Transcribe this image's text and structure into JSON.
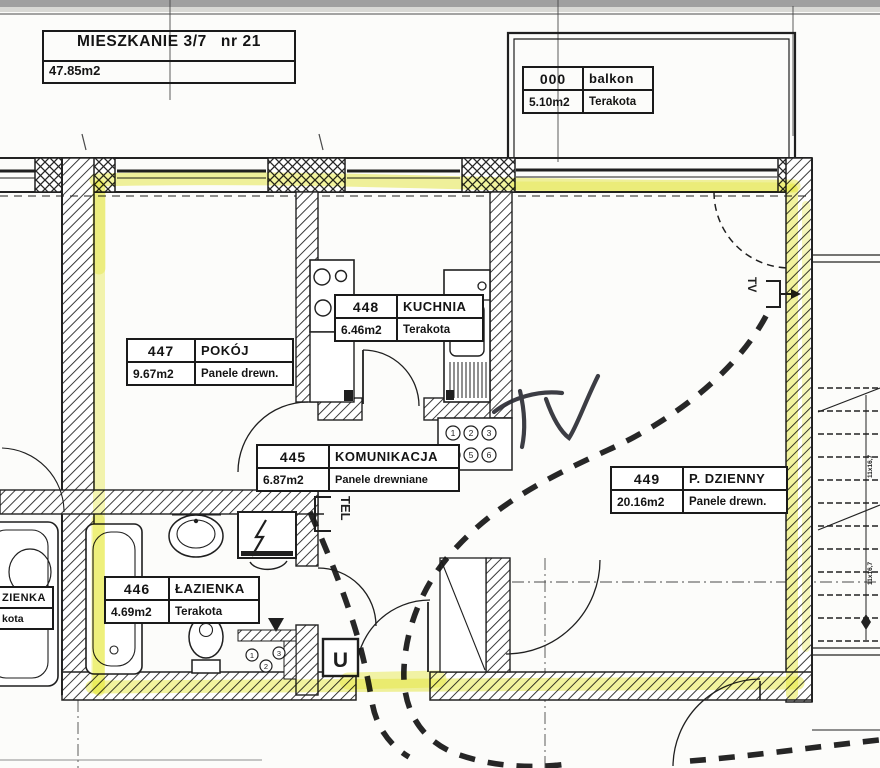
{
  "apartment": {
    "label": "MIESZKANIE 3/7",
    "unit": "nr 21",
    "total_area": "47.85m2"
  },
  "rooms": [
    {
      "id": "000",
      "name": "balkon",
      "area": "5.10m2",
      "floor": "Terakota"
    },
    {
      "id": "447",
      "name": "POKÓJ",
      "area": "9.67m2",
      "floor": "Panele drewn."
    },
    {
      "id": "448",
      "name": "KUCHNIA",
      "area": "6.46m2",
      "floor": "Terakota"
    },
    {
      "id": "445",
      "name": "KOMUNIKACJA",
      "area": "6.87m2",
      "floor": "Panele drewniane"
    },
    {
      "id": "449",
      "name": "P. DZIENNY",
      "area": "20.16m2",
      "floor": "Panele drewn."
    },
    {
      "id": "446",
      "name": "ŁAZIENKA",
      "area": "4.69m2",
      "floor": "Terakota"
    }
  ],
  "neighbor_label": {
    "name_fragment": "ZIENKA",
    "floor_fragment": "kota"
  },
  "annotations": {
    "tv_handwritten": "TV",
    "tel_socket": "TEL",
    "tv_socket": "TV",
    "u_symbol": "U",
    "stairs_step_note": "11x16,7"
  },
  "shafts": {
    "kitchen_risers": [
      "1",
      "2",
      "3",
      "4",
      "5",
      "6"
    ],
    "bathroom_risers": [
      "1",
      "2",
      "3"
    ]
  },
  "colors": {
    "highlighter": "#e6e83c",
    "ink": "#1f1f1f"
  }
}
